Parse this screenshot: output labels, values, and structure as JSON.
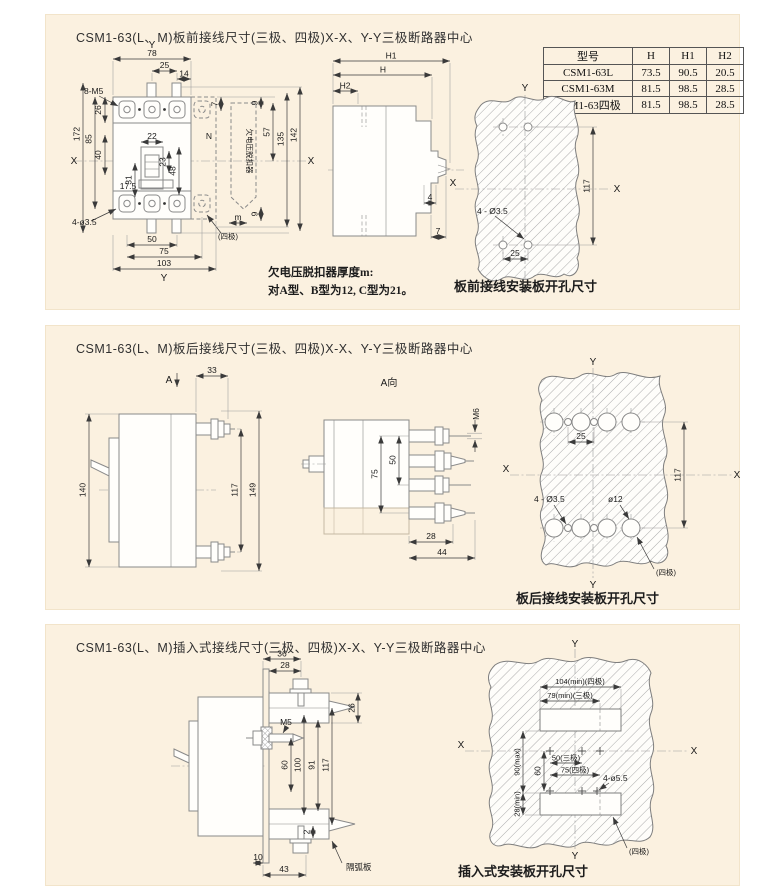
{
  "page": {
    "bg": "#ffffff",
    "panel_bg": "#fbf1e0",
    "line_color": "#8a8a8a",
    "dim_color": "#3a3a3a"
  },
  "panel1": {
    "title": "CSM1-63(L、M)板前接线尺寸(三极、四极)X-X、Y-Y三极断路器中心",
    "front": {
      "axis_y_top": "Y",
      "w78": "78",
      "w25": "25",
      "w14": "14",
      "screws": "8-M5",
      "h26": "26",
      "h40": "40",
      "h85": "85",
      "h172": "172",
      "axis_x_left": "X",
      "w22": "22",
      "h23": "23",
      "h48": "48",
      "h31": "31",
      "d17_5": "17.5",
      "n_pole": "N",
      "h7": "7",
      "h9_top": "9",
      "h57": "57",
      "h135": "135",
      "h142": "142",
      "h9_bot": "9",
      "axis_x_right": "X",
      "m_dim": "m",
      "four_pole": "(四极)",
      "holes": "4-ø3.5",
      "w50": "50",
      "w75": "75",
      "w103": "103",
      "axis_y_bot": "Y",
      "uv_release": "欠电压脱扣器"
    },
    "side": {
      "h1": "H1",
      "h": "H",
      "h2": "H2",
      "d4": "4",
      "d7": "7"
    },
    "table": {
      "headers": [
        "型号",
        "H",
        "H1",
        "H2"
      ],
      "rows": [
        [
          "CSM1-63L",
          "73.5",
          "90.5",
          "20.5"
        ],
        [
          "CSM1-63M",
          "81.5",
          "98.5",
          "28.5"
        ],
        [
          "CSM1-63四极",
          "81.5",
          "98.5",
          "28.5"
        ]
      ]
    },
    "plate": {
      "axis_y_top": "Y",
      "axis_y_bot": "Y",
      "axis_x_left": "X",
      "axis_x_right": "X",
      "h117": "117",
      "holes": "4 - Ø3.5",
      "w25": "25",
      "caption": "板前接线安装板开孔尺寸"
    },
    "note1": "欠电压脱扣器厚度m:",
    "note2": "对A型、B型为12, C型为21。"
  },
  "panel2": {
    "title": "CSM1-63(L、M)板后接线尺寸(三极、四极)X-X、Y-Y三极断路器中心",
    "left": {
      "a_label": "A",
      "w33": "33",
      "h140": "140",
      "h117": "117",
      "h149": "149"
    },
    "center": {
      "a_view": "A向",
      "m6": "M6",
      "h50": "50",
      "h75": "75",
      "w28": "28",
      "w44": "44"
    },
    "plate": {
      "axis_y_top": "Y",
      "axis_y_bot": "Y",
      "axis_x_left": "X",
      "axis_x_right": "X",
      "w25": "25",
      "h117": "117",
      "holes": "4 - Ø3.5",
      "d12": "ø12",
      "four_pole": "(四极)",
      "caption": "板后接线安装板开孔尺寸"
    }
  },
  "panel3": {
    "title": "CSM1-63(L、M)插入式接线尺寸(三极、四极)X-X、Y-Y三极断路器中心",
    "left": {
      "w36": "36",
      "w28": "28",
      "h26": "26",
      "m5": "M5",
      "h60": "60",
      "h100": "100",
      "h91": "91",
      "h117": "117",
      "d2": "2",
      "w10": "10",
      "w43": "43",
      "arc_plate": "隔弧板"
    },
    "plate": {
      "axis_y_top": "Y",
      "axis_y_bot": "Y",
      "axis_x_left": "X",
      "axis_x_right": "X",
      "w104": "104(min)(四极)",
      "w79": "79(min)(三极)",
      "w50": "50(三极)",
      "w75": "75(四极)",
      "h60": "60",
      "h90": "90(max)",
      "h28": "28(min)",
      "holes": "4-ø5.5",
      "four_pole": "(四极)",
      "caption": "插入式安装板开孔尺寸"
    }
  }
}
